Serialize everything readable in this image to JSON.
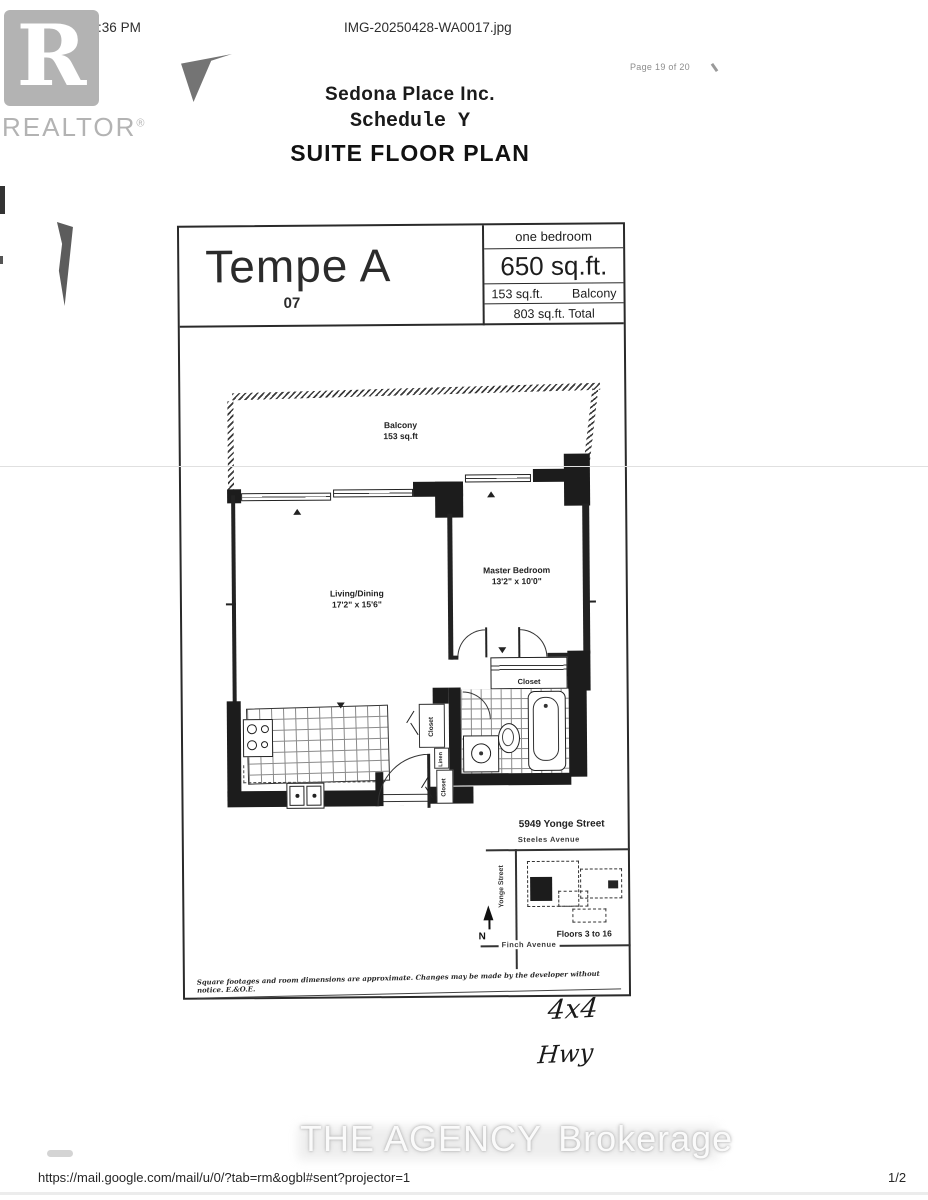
{
  "header": {
    "timestamp": "6/12/25, 5:36 PM",
    "filename": "IMG-20250428-WA0017.jpg",
    "page_indicator": "Page 19 of 20"
  },
  "watermarks": {
    "realtor_r": "R",
    "realtor": "REALTOR",
    "realtor_reg": "®",
    "agency": "THE AGENCY",
    "agency_suffix": "Brokerage"
  },
  "doc_title": {
    "line1": "Sedona Place Inc.",
    "line2": "Schedule Y",
    "line3": "SUITE FLOOR PLAN"
  },
  "plan_header": {
    "model": "Tempe A",
    "unit": "07",
    "type": "one bedroom",
    "area": "650 sq.ft.",
    "balcony_area": "153 sq.ft.",
    "balcony_label": "Balcony",
    "total": "803 sq.ft. Total"
  },
  "rooms": {
    "balcony_name": "Balcony",
    "balcony_area": "153 sq.ft",
    "living_name": "Living/Dining",
    "living_dims": "17'2\" x 15'6\"",
    "bedroom_name": "Master Bedroom",
    "bedroom_dims": "13'2\" x 10'0\"",
    "bedroom_closet": "Closet",
    "entry_closet_top": "Closet",
    "linen": "Linen",
    "entry_closet_bottom": "Closet"
  },
  "site_map": {
    "address": "5949 Yonge Street",
    "street_top": "Steeles Avenue",
    "street_left": "Yonge Street",
    "street_bottom": "Finch Avenue",
    "floors": "Floors 3 to 16",
    "compass": "N"
  },
  "disclaimer": "Square footages and room dimensions are approximate. Changes may be made by the developer without notice. E.&O.E.",
  "handwritten": {
    "note1": "4x4",
    "note2": "Hwy"
  },
  "footer": {
    "url": "https://mail.google.com/mail/u/0/?tab=rm&ogbl#sent?projector=1",
    "page_fraction": "1/2"
  }
}
